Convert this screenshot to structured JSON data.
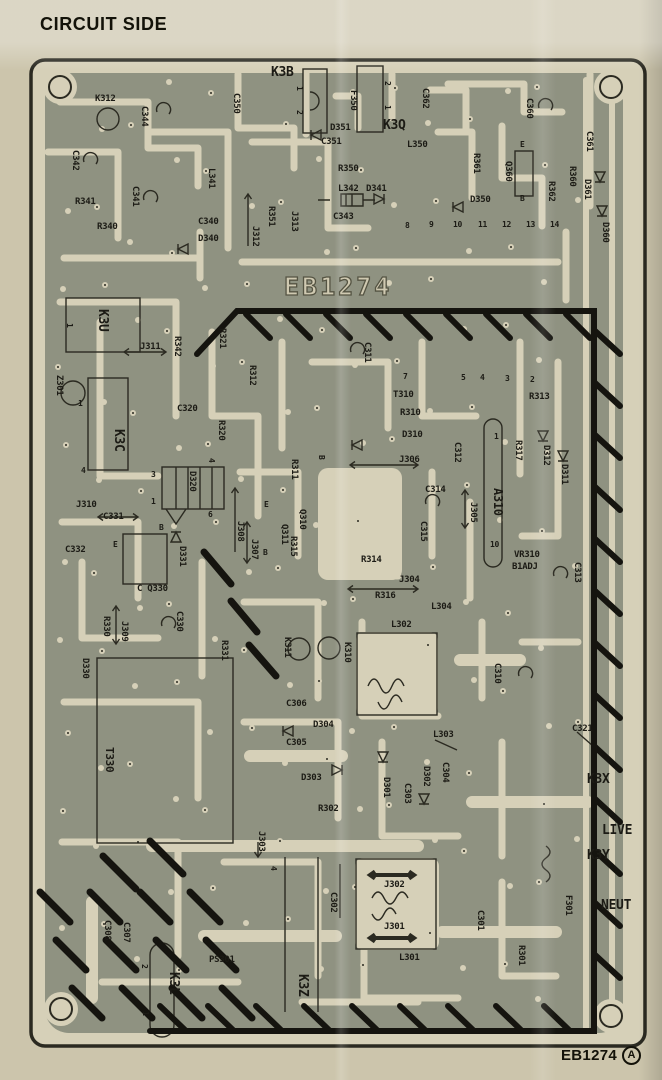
{
  "title": "CIRCUIT SIDE",
  "watermark": "EB1274",
  "footer": {
    "id": "EB1274",
    "revision": "A"
  },
  "colors": {
    "paper": "#ccc5ac",
    "board": "#d6d0b8",
    "copper": "#8f9281",
    "ink": "#2b2a21"
  },
  "board": {
    "labels": [
      {
        "t": "K3B",
        "x": 271,
        "y": 66,
        "s": 13
      },
      {
        "t": "K3Q",
        "x": 383,
        "y": 119,
        "s": 13
      },
      {
        "t": "D351",
        "x": 330,
        "y": 124
      },
      {
        "t": "C351",
        "x": 321,
        "y": 138
      },
      {
        "t": "L350",
        "x": 407,
        "y": 141
      },
      {
        "t": "R350",
        "x": 338,
        "y": 165
      },
      {
        "t": "L342",
        "x": 338,
        "y": 185
      },
      {
        "t": "D341",
        "x": 366,
        "y": 185
      },
      {
        "t": "C343",
        "x": 333,
        "y": 213
      },
      {
        "t": "K312",
        "x": 95,
        "y": 95
      },
      {
        "t": "R341",
        "x": 75,
        "y": 198
      },
      {
        "t": "R340",
        "x": 97,
        "y": 223
      },
      {
        "t": "C340",
        "x": 198,
        "y": 218
      },
      {
        "t": "D340",
        "x": 198,
        "y": 235
      },
      {
        "t": "D350",
        "x": 470,
        "y": 196
      },
      {
        "t": "C350",
        "x": 231,
        "y": 93,
        "r": 90
      },
      {
        "t": "C344",
        "x": 139,
        "y": 106,
        "r": 90
      },
      {
        "t": "C362",
        "x": 420,
        "y": 88,
        "r": 90
      },
      {
        "t": "F350",
        "x": 348,
        "y": 90,
        "r": 90
      },
      {
        "t": "C342",
        "x": 70,
        "y": 150,
        "r": 90
      },
      {
        "t": "L341",
        "x": 206,
        "y": 168,
        "r": 90
      },
      {
        "t": "C341",
        "x": 130,
        "y": 186,
        "r": 90
      },
      {
        "t": "R351",
        "x": 266,
        "y": 206,
        "r": 90
      },
      {
        "t": "J313",
        "x": 289,
        "y": 211,
        "r": 90
      },
      {
        "t": "J312",
        "x": 250,
        "y": 226,
        "r": 90
      },
      {
        "t": "C360",
        "x": 524,
        "y": 98,
        "r": 90
      },
      {
        "t": "C361",
        "x": 584,
        "y": 131,
        "r": 90
      },
      {
        "t": "R361",
        "x": 471,
        "y": 153,
        "r": 90
      },
      {
        "t": "Q360",
        "x": 503,
        "y": 161,
        "r": 90
      },
      {
        "t": "R360",
        "x": 567,
        "y": 166,
        "r": 90
      },
      {
        "t": "R362",
        "x": 546,
        "y": 181,
        "r": 90
      },
      {
        "t": "D361",
        "x": 582,
        "y": 179,
        "r": 90
      },
      {
        "t": "D360",
        "x": 600,
        "y": 222,
        "r": 90
      },
      {
        "t": "E",
        "x": 520,
        "y": 141,
        "s": 8
      },
      {
        "t": "B",
        "x": 520,
        "y": 195,
        "s": 8
      },
      {
        "t": "1",
        "x": 294,
        "y": 86,
        "r": 90,
        "s": 8
      },
      {
        "t": "2",
        "x": 294,
        "y": 110,
        "r": 90,
        "s": 8
      },
      {
        "t": "2",
        "x": 382,
        "y": 81,
        "r": 90,
        "s": 8
      },
      {
        "t": "1",
        "x": 382,
        "y": 105,
        "r": 90,
        "s": 8
      },
      {
        "t": "8",
        "x": 405,
        "y": 222,
        "s": 8
      },
      {
        "t": "9",
        "x": 429,
        "y": 221,
        "s": 8
      },
      {
        "t": "10",
        "x": 453,
        "y": 221,
        "s": 8
      },
      {
        "t": "11",
        "x": 478,
        "y": 221,
        "s": 8
      },
      {
        "t": "12",
        "x": 502,
        "y": 221,
        "s": 8
      },
      {
        "t": "13",
        "x": 526,
        "y": 221,
        "s": 8
      },
      {
        "t": "14",
        "x": 550,
        "y": 221,
        "s": 8
      },
      {
        "t": "7",
        "x": 403,
        "y": 373,
        "s": 8
      },
      {
        "t": "5",
        "x": 461,
        "y": 374,
        "s": 8
      },
      {
        "t": "4",
        "x": 480,
        "y": 374,
        "s": 8
      },
      {
        "t": "3",
        "x": 505,
        "y": 375,
        "s": 8
      },
      {
        "t": "2",
        "x": 530,
        "y": 376,
        "s": 8
      },
      {
        "t": "K3U",
        "x": 100,
        "y": 309,
        "r": 90,
        "s": 13
      },
      {
        "t": "1",
        "x": 64,
        "y": 323,
        "r": 90,
        "s": 8
      },
      {
        "t": "J311",
        "x": 140,
        "y": 343
      },
      {
        "t": "R342",
        "x": 172,
        "y": 336,
        "r": 90
      },
      {
        "t": "R321",
        "x": 217,
        "y": 328,
        "r": 90
      },
      {
        "t": "R312",
        "x": 247,
        "y": 365,
        "r": 90
      },
      {
        "t": "C320",
        "x": 177,
        "y": 405
      },
      {
        "t": "R320",
        "x": 216,
        "y": 420,
        "r": 90
      },
      {
        "t": "K3C",
        "x": 116,
        "y": 429,
        "r": 90,
        "s": 13
      },
      {
        "t": "Z301",
        "x": 54,
        "y": 375,
        "r": 90
      },
      {
        "t": "1",
        "x": 78,
        "y": 400,
        "s": 8
      },
      {
        "t": "C311",
        "x": 362,
        "y": 342,
        "r": 90
      },
      {
        "t": "T310",
        "x": 393,
        "y": 391
      },
      {
        "t": "R310",
        "x": 400,
        "y": 409
      },
      {
        "t": "D310",
        "x": 402,
        "y": 431
      },
      {
        "t": "J306",
        "x": 399,
        "y": 456
      },
      {
        "t": "B",
        "x": 316,
        "y": 455,
        "r": 90,
        "s": 8
      },
      {
        "t": "C312",
        "x": 452,
        "y": 442,
        "r": 90
      },
      {
        "t": "R313",
        "x": 529,
        "y": 393
      },
      {
        "t": "R317",
        "x": 513,
        "y": 440,
        "r": 90
      },
      {
        "t": "D312",
        "x": 541,
        "y": 445,
        "r": 90
      },
      {
        "t": "D311",
        "x": 559,
        "y": 464,
        "r": 90
      },
      {
        "t": "A310",
        "x": 495,
        "y": 488,
        "r": 90,
        "s": 12
      },
      {
        "t": "1",
        "x": 494,
        "y": 433,
        "s": 8
      },
      {
        "t": "10",
        "x": 490,
        "y": 541,
        "s": 8
      },
      {
        "t": "J305",
        "x": 468,
        "y": 502,
        "r": 90
      },
      {
        "t": "VR310",
        "x": 514,
        "y": 551
      },
      {
        "t": "B1ADJ",
        "x": 512,
        "y": 563
      },
      {
        "t": "C313",
        "x": 572,
        "y": 562,
        "r": 90
      },
      {
        "t": "C314",
        "x": 425,
        "y": 486
      },
      {
        "t": "C315",
        "x": 418,
        "y": 521,
        "r": 90
      },
      {
        "t": "4",
        "x": 206,
        "y": 458,
        "r": 90,
        "s": 8
      },
      {
        "t": "3",
        "x": 151,
        "y": 471,
        "s": 8
      },
      {
        "t": "1",
        "x": 151,
        "y": 498,
        "s": 8
      },
      {
        "t": "4",
        "x": 81,
        "y": 467,
        "s": 8
      },
      {
        "t": "6",
        "x": 208,
        "y": 511,
        "s": 8
      },
      {
        "t": "D320",
        "x": 187,
        "y": 471,
        "r": 90
      },
      {
        "t": "R311",
        "x": 289,
        "y": 459,
        "r": 90
      },
      {
        "t": "E",
        "x": 264,
        "y": 501,
        "s": 8
      },
      {
        "t": "B",
        "x": 159,
        "y": 524,
        "s": 8
      },
      {
        "t": "B",
        "x": 263,
        "y": 549,
        "s": 8
      },
      {
        "t": "Q310",
        "x": 297,
        "y": 509,
        "r": 90
      },
      {
        "t": "Q311",
        "x": 279,
        "y": 524,
        "r": 90
      },
      {
        "t": "R315",
        "x": 288,
        "y": 536,
        "r": 90
      },
      {
        "t": "J308",
        "x": 235,
        "y": 521,
        "r": 90
      },
      {
        "t": "J307",
        "x": 249,
        "y": 539,
        "r": 90
      },
      {
        "t": "J310",
        "x": 76,
        "y": 501
      },
      {
        "t": "C331",
        "x": 103,
        "y": 513
      },
      {
        "t": "C332",
        "x": 65,
        "y": 546
      },
      {
        "t": "E",
        "x": 113,
        "y": 541,
        "s": 8
      },
      {
        "t": "D331",
        "x": 177,
        "y": 546,
        "r": 90
      },
      {
        "t": "C Q330",
        "x": 137,
        "y": 585
      },
      {
        "t": "R330",
        "x": 101,
        "y": 616,
        "r": 90
      },
      {
        "t": "J309",
        "x": 119,
        "y": 621,
        "r": 90
      },
      {
        "t": "C330",
        "x": 174,
        "y": 611,
        "r": 90
      },
      {
        "t": "R331",
        "x": 219,
        "y": 640,
        "r": 90
      },
      {
        "t": "D330",
        "x": 80,
        "y": 658,
        "r": 90
      },
      {
        "t": "T330",
        "x": 106,
        "y": 747,
        "r": 90,
        "s": 11
      },
      {
        "t": "R314",
        "x": 361,
        "y": 556
      },
      {
        "t": "J304",
        "x": 399,
        "y": 576
      },
      {
        "t": "R316",
        "x": 375,
        "y": 592
      },
      {
        "t": "L304",
        "x": 431,
        "y": 603
      },
      {
        "t": "L302",
        "x": 391,
        "y": 621
      },
      {
        "t": "K311",
        "x": 282,
        "y": 637,
        "r": 90
      },
      {
        "t": "K310",
        "x": 342,
        "y": 642,
        "r": 90
      },
      {
        "t": "C310",
        "x": 492,
        "y": 663,
        "r": 90
      },
      {
        "t": "C306",
        "x": 286,
        "y": 700
      },
      {
        "t": "D304",
        "x": 313,
        "y": 721
      },
      {
        "t": "C305",
        "x": 286,
        "y": 739
      },
      {
        "t": "D303",
        "x": 301,
        "y": 774
      },
      {
        "t": "L303",
        "x": 433,
        "y": 731
      },
      {
        "t": "D301",
        "x": 381,
        "y": 777,
        "r": 90
      },
      {
        "t": "C303",
        "x": 402,
        "y": 783,
        "r": 90
      },
      {
        "t": "D302",
        "x": 421,
        "y": 766,
        "r": 90
      },
      {
        "t": "C304",
        "x": 440,
        "y": 762,
        "r": 90
      },
      {
        "t": "R302",
        "x": 318,
        "y": 805
      },
      {
        "t": "C321",
        "x": 572,
        "y": 725
      },
      {
        "t": "K3X",
        "x": 587,
        "y": 773,
        "s": 13
      },
      {
        "t": "LIVE",
        "x": 602,
        "y": 824,
        "s": 13
      },
      {
        "t": "K3Y",
        "x": 587,
        "y": 849,
        "s": 13
      },
      {
        "t": "NEUT",
        "x": 601,
        "y": 899,
        "s": 13
      },
      {
        "t": "F301",
        "x": 563,
        "y": 895,
        "r": 90
      },
      {
        "t": "C301",
        "x": 475,
        "y": 910,
        "r": 90
      },
      {
        "t": "R301",
        "x": 516,
        "y": 945,
        "r": 90
      },
      {
        "t": "J303",
        "x": 256,
        "y": 831,
        "r": 90
      },
      {
        "t": "4",
        "x": 268,
        "y": 866,
        "r": 90,
        "s": 8
      },
      {
        "t": "C302",
        "x": 328,
        "y": 892,
        "r": 90
      },
      {
        "t": "J302",
        "x": 384,
        "y": 881
      },
      {
        "t": "J301",
        "x": 384,
        "y": 923
      },
      {
        "t": "L301",
        "x": 399,
        "y": 954
      },
      {
        "t": "PS301",
        "x": 209,
        "y": 956
      },
      {
        "t": "K3L",
        "x": 171,
        "y": 972,
        "r": 90,
        "s": 13
      },
      {
        "t": "K3Z",
        "x": 300,
        "y": 974,
        "r": 90,
        "s": 13
      },
      {
        "t": "C307",
        "x": 121,
        "y": 922,
        "r": 90
      },
      {
        "t": "C308",
        "x": 102,
        "y": 920,
        "r": 90
      },
      {
        "t": "2",
        "x": 139,
        "y": 964,
        "r": 90,
        "s": 8
      },
      {
        "t": "1",
        "x": 140,
        "y": 1011,
        "r": 90,
        "s": 8
      }
    ]
  }
}
